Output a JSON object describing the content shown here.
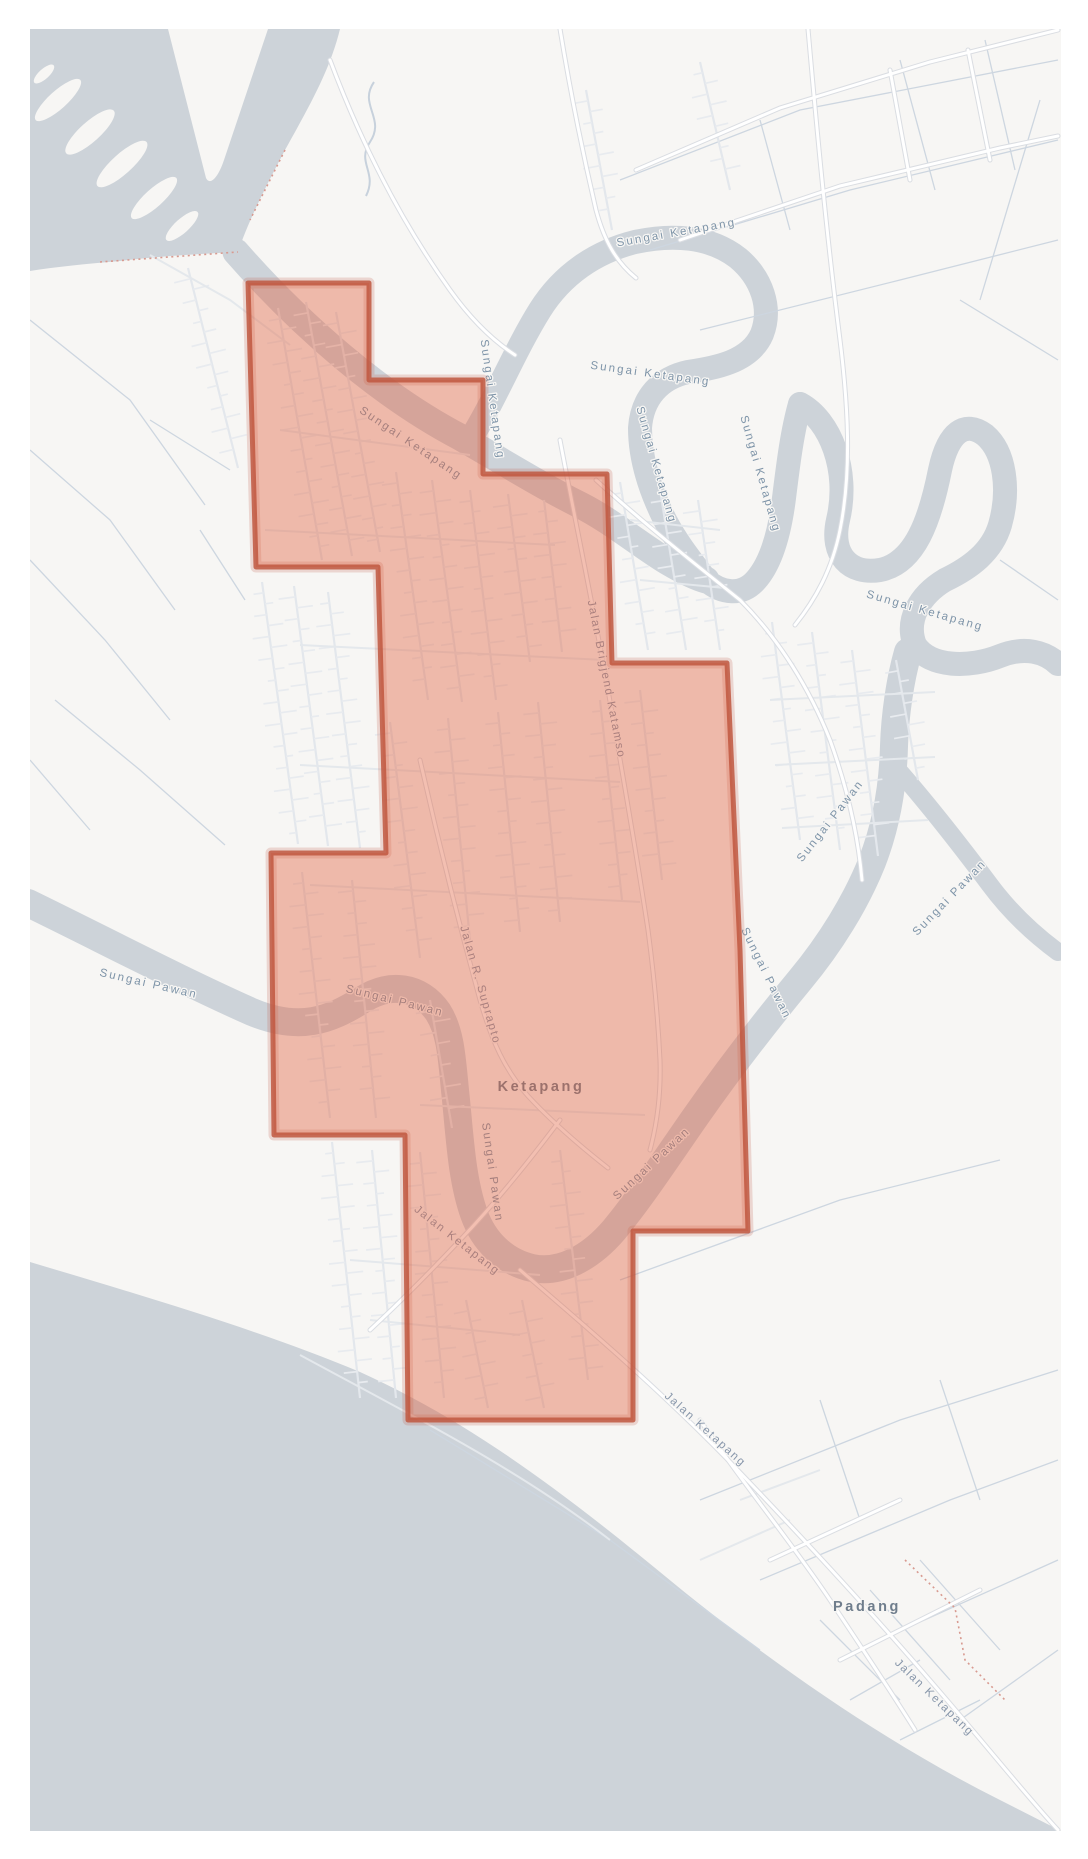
{
  "map": {
    "region_name": "Ketapang urban boundary overlay",
    "labels": [
      {
        "text": "Sungai Ketapang",
        "kind": "water"
      },
      {
        "text": "Sungai Ketapang",
        "kind": "water"
      },
      {
        "text": "Sungai Ketapang",
        "kind": "water"
      },
      {
        "text": "Sungai Ketapang",
        "kind": "water"
      },
      {
        "text": "Sungai Ketapang",
        "kind": "water"
      },
      {
        "text": "Sungai Ketapang",
        "kind": "water"
      },
      {
        "text": "Sungai Ketapang",
        "kind": "water"
      },
      {
        "text": "Sungai Pawan",
        "kind": "water"
      },
      {
        "text": "Sungai Pawan",
        "kind": "water"
      },
      {
        "text": "Sungai Pawan",
        "kind": "water"
      },
      {
        "text": "Sungai Pawan",
        "kind": "water"
      },
      {
        "text": "Sungai Pawan",
        "kind": "water"
      },
      {
        "text": "Sungai Pawan",
        "kind": "water"
      },
      {
        "text": "Sungai Pawan",
        "kind": "water"
      },
      {
        "text": "Jalan Brigjend Katamso",
        "kind": "road"
      },
      {
        "text": "Jalan R. Suprapto",
        "kind": "road"
      },
      {
        "text": "Jalan Ketapang",
        "kind": "road"
      },
      {
        "text": "Jalan Ketapang",
        "kind": "road"
      },
      {
        "text": "Jalan Ketapang",
        "kind": "road"
      },
      {
        "text": "Ketapang",
        "kind": "city"
      },
      {
        "text": "Padang",
        "kind": "city"
      }
    ],
    "colors": {
      "land": "#f7f6f4",
      "water": "#cdd3d9",
      "overlay_fill": "#e05f3c",
      "overlay_fill_opacity": "0.40",
      "overlay_stroke": "#bf5740",
      "water_label": "#7e94a8",
      "road_label": "#8796aa",
      "city_label": "#6f7d8c",
      "admin_boundary_dots": "#d89a90"
    }
  }
}
